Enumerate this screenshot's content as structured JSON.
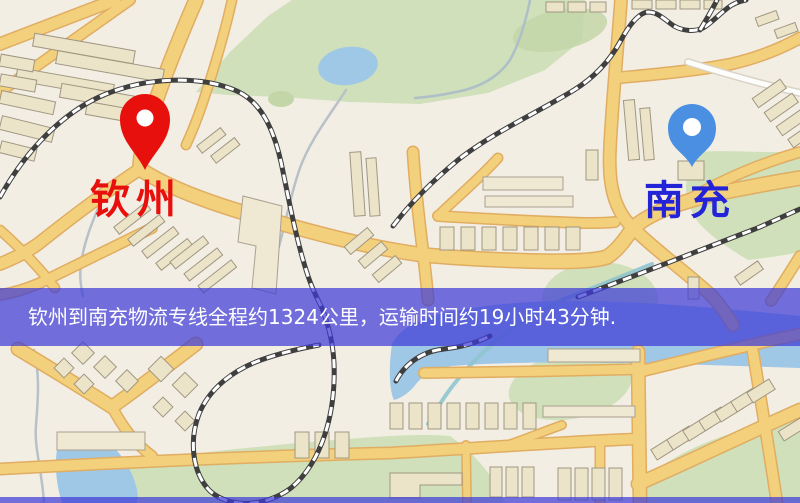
{
  "map": {
    "origin": {
      "label": "钦州",
      "pin_color": "#e8100c",
      "label_color": "#e8100c"
    },
    "destination": {
      "label": "南充",
      "pin_color": "#4a8fe2",
      "label_color": "#2323d8"
    },
    "banner": {
      "text": "钦州到南充物流专线全程约1324公里，运输时间约19小时43分钟.",
      "bg_color": "rgba(62,60,215,0.72)",
      "text_color": "#ffffff"
    },
    "palette": {
      "background": "#f3eee4",
      "road": "#f3d07b",
      "road_casing": "#e0ad62",
      "building": "#ece4c8",
      "green_area": "#cfe0ba",
      "water": "#9fc7e6",
      "railway": "#3f3f3f"
    }
  }
}
